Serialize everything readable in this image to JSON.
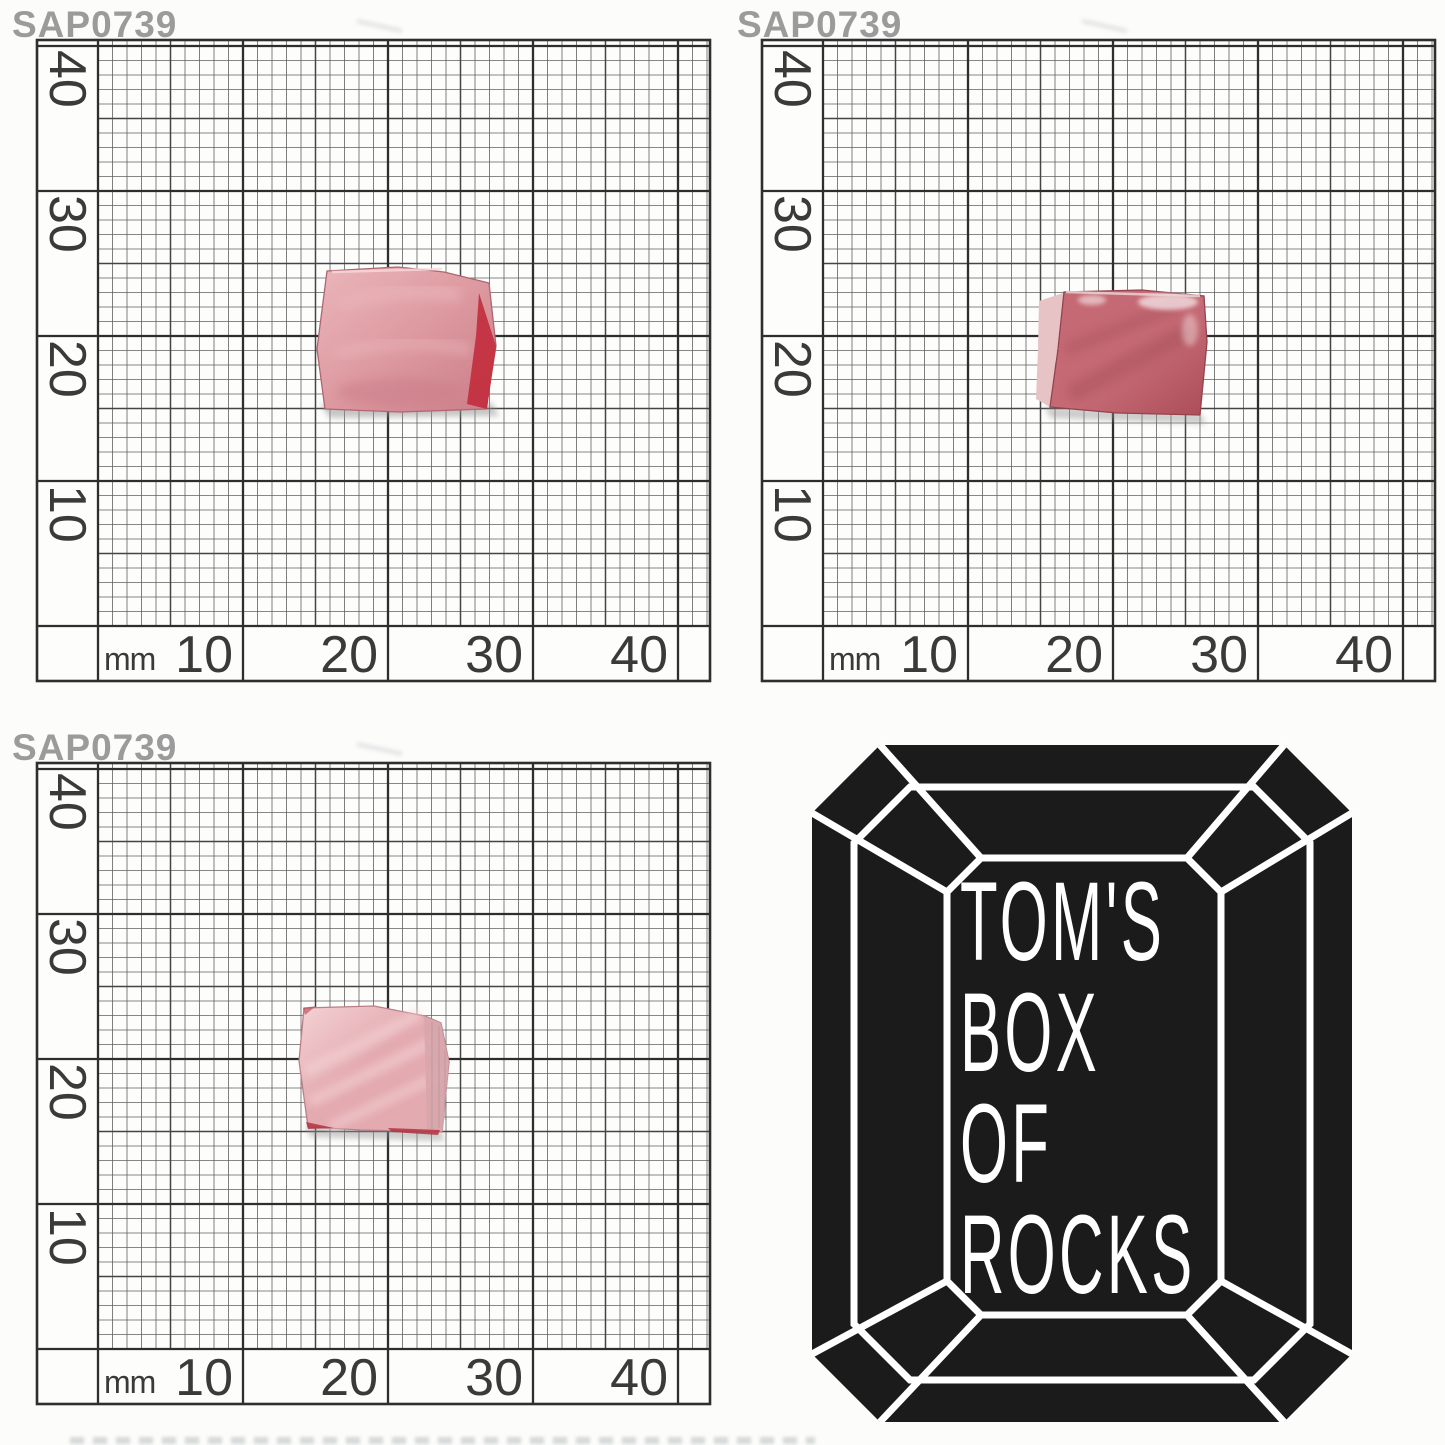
{
  "image": {
    "width": 1445,
    "height": 1445,
    "background": "#fcfcfb",
    "description": "Three photos of pink gem rough SAP0739 on millimeter graph paper plus Tom's Box of Rocks logo"
  },
  "watermark": {
    "text": "SAP0739",
    "color": "#9b9b9b"
  },
  "ruler": {
    "unit_label": "mm",
    "left_labels": [
      "40",
      "30",
      "20",
      "10"
    ],
    "bottom_labels": [
      "10",
      "20",
      "30",
      "40"
    ],
    "px_per_mm": 14.5,
    "paper_color": "#fdfdfc",
    "line_color_major": "#2e2e2e",
    "line_color_medium": "#454545",
    "line_color_minor": "#606060",
    "label_color": "#3a3a3a"
  },
  "panels": [
    {
      "name": "top-left",
      "kind": "stone-photo",
      "stone_span_mm": {
        "x": [
          15.1,
          27.4
        ],
        "y": [
          15.0,
          24.6
        ]
      }
    },
    {
      "name": "top-right",
      "kind": "stone-photo",
      "stone_span_mm": {
        "x": [
          14.7,
          26.4
        ],
        "y": [
          14.5,
          23.0
        ]
      }
    },
    {
      "name": "bottom-left",
      "kind": "stone-photo",
      "stone_span_mm": {
        "x": [
          14.2,
          24.1
        ],
        "y": [
          15.0,
          23.5
        ]
      }
    },
    {
      "name": "bottom-right",
      "kind": "logo"
    }
  ],
  "stones": {
    "top_left": {
      "body": "#dd9aa0",
      "body_light": "#eab6ba",
      "body_dark": "#cb7d88",
      "facet_dark_red": "#c22f3e",
      "edge": "#b06570",
      "highlight": "#f6dadd"
    },
    "top_right": {
      "body": "#c56a74",
      "body_dark": "#ac4d5a",
      "pale_edge": "#e7c3c6",
      "chalk": "#efd9da",
      "edge": "#94434e",
      "streak": "#a04a56"
    },
    "bottom_left": {
      "body": "#e3aab0",
      "frost": "#f4d2d5",
      "translucent_edge": "#d7a6ac",
      "dark_sliver": "#b23442",
      "edge": "#b97f87"
    }
  },
  "logo": {
    "lines": [
      "TOM'S",
      "BOX",
      "OF",
      "ROCKS"
    ],
    "gem_color": "#1b1b1b",
    "outline_color": "#ffffff",
    "text_color": "#ffffff"
  },
  "shadow_color": "#8f8f8f"
}
